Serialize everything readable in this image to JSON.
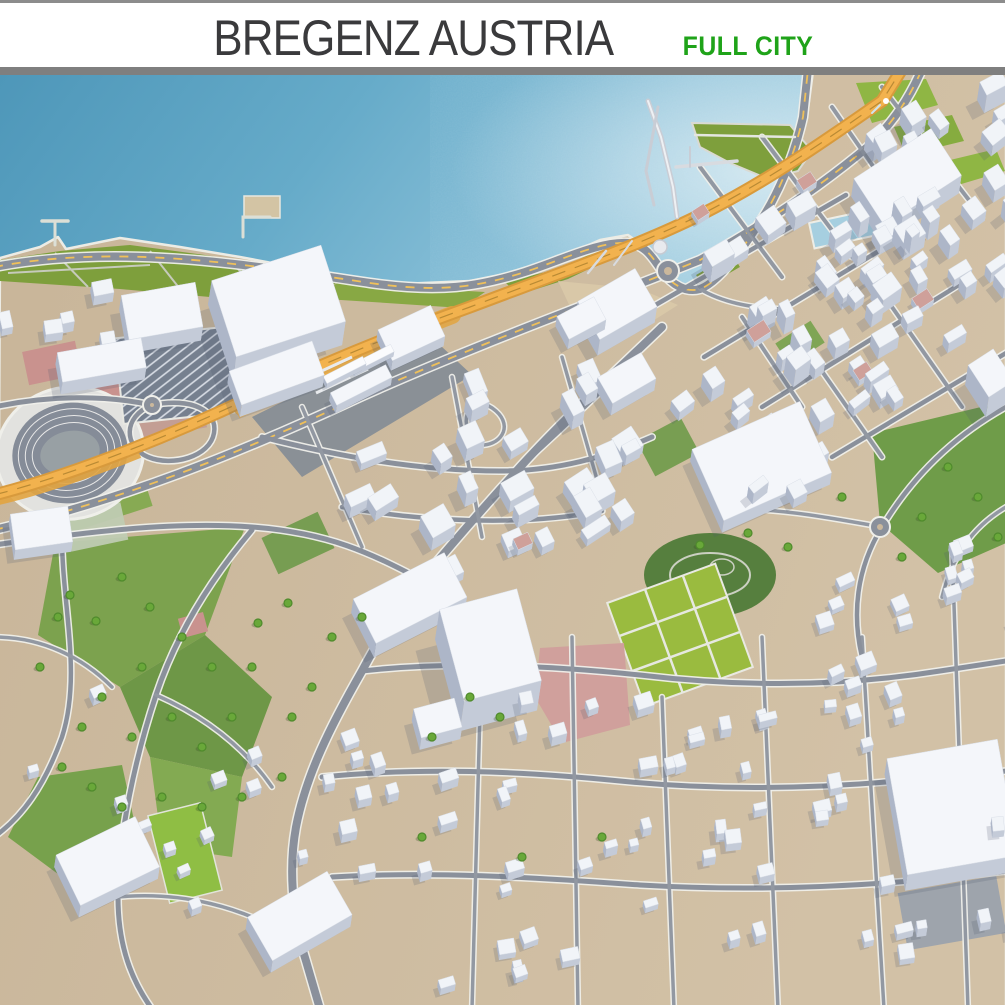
{
  "header": {
    "title": "BREGENZ AUSTRIA",
    "subtitle": "FULL CITY",
    "title_color": "#3A3A3C",
    "subtitle_color": "#1FA319",
    "bar_color": "#7F7F7F"
  },
  "map": {
    "colors": {
      "water_dark": "#4E97B9",
      "water_mid": "#6FAECB",
      "water_light": "#9CCBDE",
      "land": "#CBB89C",
      "land_light": "#D2C1A6",
      "park_olive": "#7E9F3C",
      "park_bright": "#9ABB3F",
      "park_dark": "#567F3E",
      "road_core": "#8A909B",
      "road_small": "#9298A2",
      "road_casing": "#EFEFEA",
      "rail_orange": "#E2A440",
      "rail_light": "#F2B24E",
      "rail_dark": "#D89A3C",
      "yellow_dash": "#EFC05A",
      "roof": "#F1F4F8",
      "side": "#C4CBD8",
      "side_dark": "#ADB6C8",
      "pink": "#C9928E",
      "pink_roof": "#CFA09A",
      "shadow": "rgba(80,90,110,0.20)",
      "tree": "#69A839",
      "tree_rim": "#4F8A2C",
      "seawall": "#ECECE5"
    },
    "land_path": "M0,183 L40,172 L58,162 L66,174 L120,163 L180,172 L240,182 L320,197 L400,209 L470,206 L520,196 L560,183 L600,165 L628,160 L645,172 L658,190 L672,205 L690,215 L705,205 L730,180 L757,148 L778,118 L795,82 L807,42 L813,-4 L1006,-4 L1006,934 L-4,934 Z",
    "terrain": [
      {
        "d": "M0,185 L60,176 L130,170 L205,180 L275,192 L345,204 L300,226 L210,222 L120,214 L0,206 Z",
        "f": "#7E9F3C"
      },
      {
        "d": "M345,204 L432,214 L485,217 L462,233 L372,227 L310,223 Z",
        "f": "#88A844"
      },
      {
        "d": "M505,207 L562,193 L602,173 L614,182 L568,204 L518,220 Z",
        "f": "#7E9F3C"
      },
      {
        "d": "M632,218 L668,224 L662,238 L628,231 Z",
        "f": "#7E9F3C"
      },
      {
        "d": "M558,206 L640,214 L678,230 L640,254 L572,236 Z",
        "f": "#D9C8A8"
      },
      {
        "d": "M692,48 L790,50 L812,76 L798,96 L768,104 L730,88 L700,72 Z",
        "f": "#7E9F3C",
        "s": "#DADAD2",
        "sw": 2
      },
      {
        "d": "M856,8 L926,4 L938,30 L872,48 Z",
        "f": "#8FB644"
      },
      {
        "d": "M894,52 L952,40 L964,66 L906,80 Z",
        "f": "#86AC3F"
      },
      {
        "d": "M946,86 L996,74 L1005,96 L958,110 Z",
        "f": "#8FB644"
      },
      {
        "d": "M872,358 L1006,326 L1006,468 L938,498 L880,448 Z",
        "f": "#6F9C49"
      },
      {
        "d": "M55,468 L245,452 L205,560 L120,612 L38,560 Z",
        "f": "#7CA24E"
      },
      {
        "d": "M120,612 L205,560 L272,622 L242,702 L150,682 Z",
        "f": "#6E9747"
      },
      {
        "d": "M38,702 L122,690 L142,782 L62,802 L8,762 Z",
        "f": "#77A14C"
      },
      {
        "d": "M150,682 L242,702 L232,782 L162,772 Z",
        "f": "#83AA52"
      },
      {
        "d": "M252,342 L425,256 L472,300 L302,402 Z",
        "f": "#7E8894",
        "o": 0.85
      },
      {
        "r": [
          105,
          438,
          95,
          16,
          -18
        ],
        "f": "#7FA84B",
        "o": 0.9
      },
      {
        "r": [
          298,
          468,
          62,
          40,
          -25
        ],
        "f": "#6E9A49",
        "o": 0.9
      },
      {
        "r": [
          668,
          372,
          50,
          40,
          -28
        ],
        "f": "#6E9A49",
        "o": 0.9
      },
      {
        "r": [
          800,
          268,
          42,
          26,
          -33
        ],
        "f": "#76A24C",
        "o": 0.9
      },
      {
        "r": [
          718,
          196,
          42,
          15,
          -30
        ],
        "f": "#7E9F3C"
      },
      {
        "e": [
          710,
          500,
          66,
          42
        ],
        "f": "#567F3E"
      },
      {
        "e": [
          710,
          500,
          40,
          22
        ],
        "f": "none",
        "s": "#CBD0C2",
        "sw": 2
      },
      {
        "e": [
          722,
          492,
          12,
          8
        ],
        "f": "none",
        "s": "#CBD0C2",
        "sw": 1.5
      },
      {
        "r": [
          680,
          560,
          115,
          110,
          -20
        ],
        "f": "#9ABB3F",
        "s": "#E9E9E2",
        "sw": 2,
        "g": 1
      },
      {
        "r": [
          185,
          778,
          54,
          90,
          -14
        ],
        "f": "#8FBE44",
        "s": "#E2E4DA",
        "sw": 1.5
      },
      {
        "d": "M540,573 L624,568 L630,650 L562,668 L535,622 Z",
        "f": "#D0A09C"
      },
      {
        "r": [
          193,
          550,
          26,
          20,
          -15
        ],
        "f": "#C9928E"
      },
      {
        "r": [
          52,
          288,
          54,
          34,
          -12
        ],
        "f": "#C9928E"
      },
      {
        "r": [
          108,
          306,
          58,
          40,
          -12
        ],
        "f": "#C9928E"
      },
      {
        "r": [
          168,
          344,
          74,
          30,
          -10
        ],
        "f": "#C29B93",
        "o": 0.9
      },
      {
        "r": [
          96,
          452,
          58,
          38,
          -12
        ],
        "f": "#BFCBB2",
        "o": 0.95
      },
      {
        "r": [
          848,
          153,
          74,
          26,
          -12
        ],
        "f": "#A6CFE0",
        "s": "#EDEDE6",
        "sw": 2
      },
      {
        "r": [
          262,
          132,
          36,
          22,
          0
        ],
        "f": "#D3C4A4",
        "s": "#E8E8E0",
        "sw": 1.5
      },
      {
        "r": [
          952,
          838,
          100,
          58,
          -10
        ],
        "f": "#98A1AD",
        "o": 0.9
      },
      {
        "d": "M8,198 L150,190 M55,178 L88,212 M150,176 L180,214 M230,186 L262,218",
        "f": "none",
        "s": "#C6CABB",
        "sw": 2
      }
    ],
    "stadium": {
      "cx": 70,
      "cy": 378,
      "rx": 74,
      "ry": 66,
      "rot": -12,
      "bowl": "#E2E2DF",
      "rim": "#EFEFEA",
      "track": "#858C98",
      "lane": "#E8E8E8",
      "infield": "#98A0A4"
    },
    "parking": {
      "r": [
        178,
        300,
        118,
        86,
        -6
      ],
      "f": "#76808F",
      "s": "#E8E8E2"
    },
    "roads": [
      {
        "d": "M-6,192 C120,168 250,190 370,208 C440,218 478,212 525,197 C562,185 600,166 628,168 C646,170 652,182 662,196 C672,210 686,218 700,214 C716,208 736,184 758,150 C778,120 794,82 803,42 L808,-6",
        "w": 8,
        "t": "y"
      },
      {
        "d": "M-6,455 C120,426 240,378 360,322 C480,268 600,225 700,185 C760,152 820,112 870,70 C895,45 910,22 922,-6",
        "w": 8,
        "t": "y"
      },
      {
        "d": "M662,252 C612,300 566,342 522,390 C486,430 452,468 422,505 C398,535 380,562 362,596 C330,652 306,700 296,752 C288,796 293,845 306,886 L320,934",
        "w": 8,
        "t": "m"
      },
      {
        "d": "M-6,470 C80,458 170,446 252,452 C330,458 370,478 422,505",
        "w": 5,
        "t": "m"
      },
      {
        "d": "M-6,332 C50,320 105,320 152,330",
        "w": 5,
        "t": "m"
      },
      {
        "d": "M152,330 C192,322 218,336 214,358 C210,382 172,392 148,382 C124,372 122,342 152,330 Z",
        "w": 4.5,
        "t": "m"
      },
      {
        "d": "M522,390 C556,360 586,330 616,302",
        "w": 4.5,
        "t": "m"
      },
      {
        "d": "M472,364 C456,338 476,318 496,336 C514,352 500,372 478,370",
        "w": 3.5,
        "t": "s"
      },
      {
        "d": "M652,232 L846,120",
        "w": 4.5,
        "t": "m"
      },
      {
        "d": "M704,282 L902,162",
        "w": 4.5,
        "t": "m"
      },
      {
        "d": "M762,332 L962,208",
        "w": 4.5,
        "t": "m"
      },
      {
        "d": "M832,382 L1006,278",
        "w": 4.5,
        "t": "m"
      },
      {
        "d": "M700,92 L782,202",
        "w": 4,
        "t": "s"
      },
      {
        "d": "M762,62 L852,182",
        "w": 4,
        "t": "s"
      },
      {
        "d": "M832,32 L922,162",
        "w": 4,
        "t": "s"
      },
      {
        "d": "M882,12 L982,142",
        "w": 4,
        "t": "s"
      },
      {
        "d": "M742,242 L802,332",
        "w": 4,
        "t": "s"
      },
      {
        "d": "M812,282 L882,382",
        "w": 4,
        "t": "s"
      },
      {
        "d": "M892,232 L962,332",
        "w": 4,
        "t": "s"
      },
      {
        "d": "M262,362 C340,382 420,396 500,396 C558,396 606,382 652,362",
        "w": 5,
        "t": "m"
      },
      {
        "d": "M342,432 C420,446 520,452 602,436",
        "w": 4.5,
        "t": "m"
      },
      {
        "d": "M302,332 L362,472",
        "w": 3.5,
        "t": "s"
      },
      {
        "d": "M452,302 L482,462",
        "w": 3.5,
        "t": "s"
      },
      {
        "d": "M562,282 L602,422",
        "w": 3.5,
        "t": "s"
      },
      {
        "d": "M362,596 C450,586 540,590 640,600 C740,612 840,612 940,596 L1006,586",
        "w": 5,
        "t": "m"
      },
      {
        "d": "M322,702 C420,692 520,696 620,706 C720,716 830,714 940,702 L1006,696",
        "w": 5,
        "t": "m"
      },
      {
        "d": "M332,802 C430,796 530,802 640,810 C760,817 880,812 1006,796",
        "w": 5,
        "t": "m"
      },
      {
        "d": "M482,562 L472,934",
        "w": 3.5,
        "t": "s"
      },
      {
        "d": "M572,562 L578,934",
        "w": 3.5,
        "t": "s"
      },
      {
        "d": "M662,622 L674,934",
        "w": 3.5,
        "t": "s"
      },
      {
        "d": "M762,562 L778,934",
        "w": 3.5,
        "t": "s"
      },
      {
        "d": "M862,562 L884,934",
        "w": 3.5,
        "t": "s"
      },
      {
        "d": "M952,472 L968,934",
        "w": 3.5,
        "t": "s"
      },
      {
        "d": "M252,455 C210,505 176,560 156,620 C136,680 118,760 118,822 C118,872 132,906 152,934",
        "w": 5,
        "t": "m"
      },
      {
        "d": "M62,462 C62,530 82,600 62,662 C44,712 22,742 -6,762",
        "w": 4.5,
        "t": "m"
      },
      {
        "d": "M156,620 C206,642 244,672 272,712",
        "w": 3.5,
        "t": "s"
      },
      {
        "d": "M118,822 C182,816 242,832 292,862",
        "w": 3.5,
        "t": "s"
      },
      {
        "d": "M-6,562 C42,562 82,582 112,612",
        "w": 3.5,
        "t": "s"
      },
      {
        "d": "M1006,332 C952,362 912,402 882,452 C856,494 852,540 862,582",
        "w": 4.5,
        "t": "m"
      },
      {
        "d": "M882,452 C836,444 796,436 746,434",
        "w": 3.5,
        "t": "s"
      },
      {
        "d": "M1006,432 C972,452 952,482 942,522",
        "w": 3.5,
        "t": "s"
      },
      {
        "d": "M700,214 C720,226 750,234 788,234",
        "w": 3.5,
        "t": "s"
      }
    ],
    "roundabouts": [
      [
        668,
        196,
        8
      ],
      [
        880,
        452,
        7
      ],
      [
        152,
        330,
        6
      ]
    ],
    "rail": {
      "main": "M-6,420 C80,398 180,356 252,322 C340,280 420,250 470,232 C560,198 640,170 700,140 C770,105 830,62 882,26 L902,-6",
      "fan": "M242,332 C310,298 380,268 452,240",
      "fan2": "M238,340 C300,312 360,288 430,262",
      "tail": "M-6,428 C40,418 90,400 140,380",
      "platforms": [
        "M300,306 L352,282",
        "M316,318 L368,294",
        "M332,330 L384,306"
      ]
    },
    "piers": [
      {
        "d": "M648,26 L661,62 L673,112 L677,142",
        "sw": 5,
        "c": "#C9CDD5"
      },
      {
        "d": "M648,26 L661,62 L673,112 L677,142",
        "sw": 2,
        "c": "#EEF0F3"
      },
      {
        "d": "M658,32 L646,96 L654,130",
        "sw": 3,
        "c": "#C9CDD5"
      },
      {
        "d": "M676,92 L737,86",
        "sw": 3.5,
        "c": "#D8DBE0"
      },
      {
        "d": "M690,72 L690,92",
        "sw": 2,
        "c": "#C9CDD5"
      },
      {
        "d": "M695,60 L795,62",
        "sw": 2.5,
        "c": "#E4E6E0"
      },
      {
        "d": "M55,146 L55,170",
        "sw": 3,
        "c": "#DCDFD6"
      },
      {
        "d": "M42,146 L68,146",
        "sw": 3.5,
        "c": "#DCDFD6"
      },
      {
        "d": "M243,162 L243,142 L270,142",
        "sw": 3,
        "c": "#DCDFD6"
      },
      {
        "d": "M588,198 L606,176",
        "sw": 2.5,
        "c": "#D8DBE0"
      },
      {
        "d": "M614,190 L632,166",
        "sw": 2,
        "c": "#D8DBE0"
      },
      {
        "d": "M880,30 L872,38",
        "sw": 2,
        "c": "#CFE4EE"
      }
    ],
    "tank": [
      660,
      172,
      7
    ],
    "boat": [
      886,
      26,
      3
    ],
    "landmarks": [
      [
        275,
        250,
        115,
        80,
        -18,
        24
      ],
      [
        160,
        250,
        75,
        45,
        -10,
        14
      ],
      [
        275,
        310,
        88,
        36,
        -20,
        12
      ],
      [
        100,
        297,
        85,
        30,
        -10,
        12
      ],
      [
        410,
        268,
        58,
        34,
        -25,
        10
      ],
      [
        615,
        245,
        66,
        44,
        -30,
        16
      ],
      [
        905,
        120,
        92,
        56,
        -33,
        18
      ],
      [
        486,
        600,
        80,
        95,
        -15,
        30
      ],
      [
        436,
        655,
        42,
        30,
        -15,
        12
      ],
      [
        760,
        398,
        118,
        78,
        -24,
        12
      ],
      [
        950,
        748,
        112,
        118,
        -10,
        16
      ],
      [
        106,
        798,
        88,
        56,
        -26,
        12
      ],
      [
        298,
        853,
        92,
        50,
        -30,
        12
      ],
      [
        408,
        537,
        102,
        50,
        -27,
        14
      ],
      [
        40,
        463,
        58,
        36,
        -8,
        10
      ],
      [
        360,
        318,
        62,
        14,
        -27,
        8
      ],
      [
        580,
        253,
        42,
        26,
        -28,
        10
      ],
      [
        625,
        315,
        50,
        30,
        -30,
        12
      ],
      [
        988,
        318,
        30,
        38,
        -33,
        20
      ]
    ],
    "trains": [
      [
        344,
        300,
        44,
        8,
        -27,
        5
      ],
      [
        372,
        288,
        44,
        8,
        -27,
        5
      ]
    ],
    "pink_buildings": [
      [
        758,
        262,
        20,
        14,
        -33,
        6
      ],
      [
        806,
        112,
        16,
        12,
        -33,
        6
      ],
      [
        922,
        230,
        18,
        13,
        -33,
        6
      ],
      [
        862,
        302,
        16,
        12,
        -33,
        6
      ],
      [
        700,
        142,
        14,
        11,
        -33,
        5
      ],
      [
        522,
        472,
        16,
        12,
        -25,
        6
      ]
    ],
    "clusters": [
      {
        "cx": 880,
        "cy": 165,
        "w": 350,
        "h": 155,
        "rot": -33,
        "n": 40,
        "s0": 10,
        "s1": 26,
        "e0": 8,
        "e1": 18,
        "seed": 11
      },
      {
        "cx": 860,
        "cy": 300,
        "w": 340,
        "h": 150,
        "rot": -33,
        "n": 30,
        "s0": 10,
        "s1": 24,
        "e0": 7,
        "e1": 14,
        "seed": 22
      },
      {
        "cx": 490,
        "cy": 410,
        "w": 300,
        "h": 190,
        "rot": -28,
        "n": 27,
        "s0": 12,
        "s1": 30,
        "e0": 7,
        "e1": 14,
        "seed": 33
      },
      {
        "cx": 900,
        "cy": 550,
        "w": 230,
        "h": 130,
        "rot": -22,
        "n": 16,
        "s0": 9,
        "s1": 18,
        "e0": 5,
        "e1": 9,
        "seed": 44
      },
      {
        "cx": 520,
        "cy": 760,
        "w": 360,
        "h": 280,
        "rot": -15,
        "n": 36,
        "s0": 8,
        "s1": 18,
        "e0": 5,
        "e1": 9,
        "seed": 55
      },
      {
        "cx": 855,
        "cy": 760,
        "w": 300,
        "h": 260,
        "rot": -12,
        "n": 28,
        "s0": 8,
        "s1": 18,
        "e0": 5,
        "e1": 9,
        "seed": 66
      },
      {
        "cx": 165,
        "cy": 745,
        "w": 300,
        "h": 300,
        "rot": -20,
        "n": 13,
        "s0": 8,
        "s1": 16,
        "e0": 5,
        "e1": 8,
        "seed": 77
      },
      {
        "cx": 65,
        "cy": 262,
        "w": 120,
        "h": 70,
        "rot": -8,
        "n": 5,
        "s0": 10,
        "s1": 20,
        "e0": 6,
        "e1": 10,
        "seed": 88
      }
    ],
    "trees": [
      [
        70,
        520
      ],
      [
        96,
        546
      ],
      [
        122,
        502
      ],
      [
        150,
        532
      ],
      [
        182,
        562
      ],
      [
        212,
        592
      ],
      [
        142,
        592
      ],
      [
        102,
        622
      ],
      [
        82,
        652
      ],
      [
        132,
        662
      ],
      [
        172,
        642
      ],
      [
        202,
        672
      ],
      [
        232,
        642
      ],
      [
        62,
        692
      ],
      [
        92,
        712
      ],
      [
        122,
        732
      ],
      [
        162,
        722
      ],
      [
        202,
        732
      ],
      [
        242,
        722
      ],
      [
        282,
        702
      ],
      [
        58,
        542
      ],
      [
        40,
        592
      ],
      [
        252,
        592
      ],
      [
        292,
        642
      ],
      [
        312,
        612
      ],
      [
        470,
        622
      ],
      [
        500,
        642
      ],
      [
        432,
        662
      ],
      [
        332,
        562
      ],
      [
        362,
        542
      ],
      [
        948,
        392
      ],
      [
        978,
        422
      ],
      [
        922,
        442
      ],
      [
        998,
        462
      ],
      [
        842,
        422
      ],
      [
        902,
        482
      ],
      [
        422,
        762
      ],
      [
        522,
        782
      ],
      [
        602,
        762
      ],
      [
        258,
        548
      ],
      [
        288,
        528
      ],
      [
        748,
        458
      ],
      [
        788,
        472
      ],
      [
        700,
        470
      ]
    ]
  }
}
